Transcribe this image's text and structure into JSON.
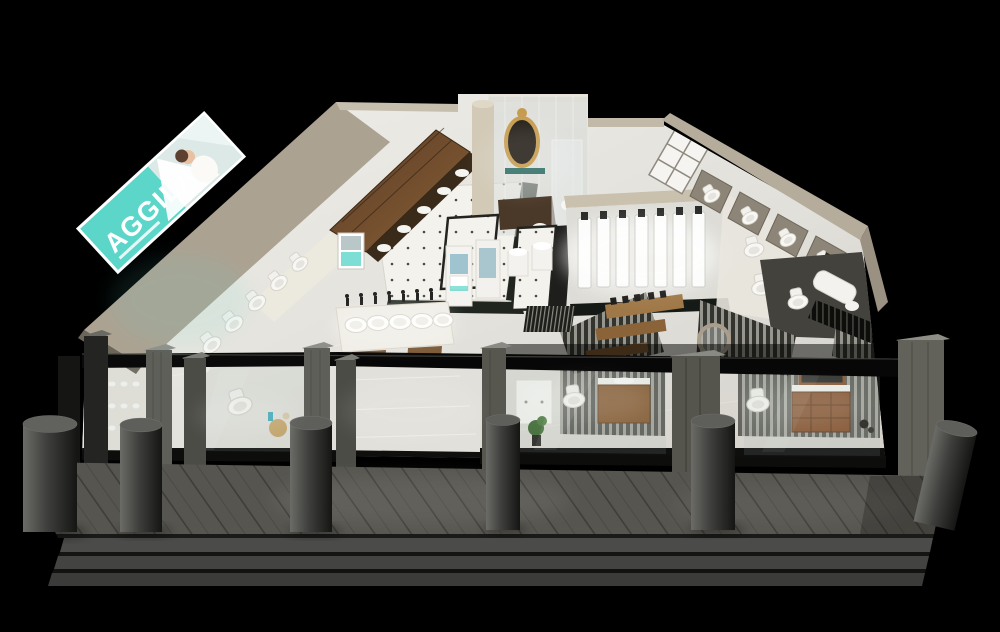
{
  "meta": {
    "description": "Night-time 3D cutaway (dollhouse) render of a sanitary-ware / bathroom showroom on a black background",
    "width": 1000,
    "height": 632
  },
  "sign": {
    "brand": "AGGILA"
  },
  "palette": {
    "background": "#000000",
    "accent_teal": "#5BD6C9",
    "floor_light": "#e8e6e0",
    "wall_taupe": "#aca292",
    "wood_brown": "#7c5a38",
    "terrace_gray": "#555351",
    "fixture_white": "#f7f6f3"
  },
  "scene": {
    "bollard_count": 6,
    "step_count": 3,
    "storefront_window_count": 4,
    "shower_column_count": 7,
    "display_basin_count": 5
  }
}
